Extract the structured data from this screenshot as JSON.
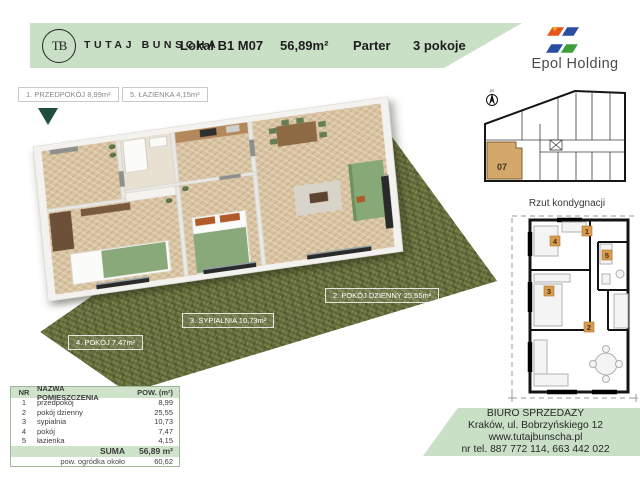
{
  "header": {
    "brand": "TUTAJ BUNSCHA",
    "logo_monogram": "TB",
    "unit": "Lokal B1 M07",
    "area": "56,89m²",
    "floor": "Parter",
    "rooms": "3 pokoje"
  },
  "partner": {
    "name": "Epol Holding"
  },
  "plan": {
    "labels": {
      "przedpokoj": "1. PRZEDPOKÓJ 8,99m²",
      "lazienka": "5. ŁAZIENKA 4,15m²",
      "pokoj_dzienny": "2. POKÓJ DZIENNY 25,55m²",
      "sypialnia": "3. SYPIALNIA 10,73m²",
      "pokoj": "4. POKÓJ 7,47m²"
    }
  },
  "sidebar": {
    "compass_label": "pn",
    "unit_number": "07",
    "caption": "Rzut kondygnacji",
    "chips": {
      "c1": "1",
      "c2": "2",
      "c3": "3",
      "c4": "4",
      "c5": "5"
    }
  },
  "table": {
    "headers": {
      "nr": "NR",
      "name": "NAZWA POMIESZCZENIA",
      "area": "POW. (m²)"
    },
    "rows": [
      {
        "nr": "1",
        "name": "przedpokój",
        "area": "8,99"
      },
      {
        "nr": "2",
        "name": "pokój dzienny",
        "area": "25,55"
      },
      {
        "nr": "3",
        "name": "sypialnia",
        "area": "10,73"
      },
      {
        "nr": "4",
        "name": "pokój",
        "area": "7,47"
      },
      {
        "nr": "5",
        "name": "łazienka",
        "area": "4,15"
      }
    ],
    "suma_label": "SUMA",
    "suma_value": "56,89 m²",
    "garden_label": "pow. ogródka około",
    "garden_value": "60,62"
  },
  "contact": {
    "line1": "BIURO SPRZEDAŻY",
    "line2": "Kraków, ul. Bobrzyńskiego 12",
    "line3": "www.tutajbunscha.pl",
    "line4": "nr tel.  887 772 114, 663 442 022"
  },
  "colors": {
    "banner_green": "#c9dfc6",
    "table_green": "#cfe3cb",
    "accent_tan": "#d4a76a",
    "dark_green": "#1d4e3e",
    "grass_olive": "#6f7643"
  }
}
